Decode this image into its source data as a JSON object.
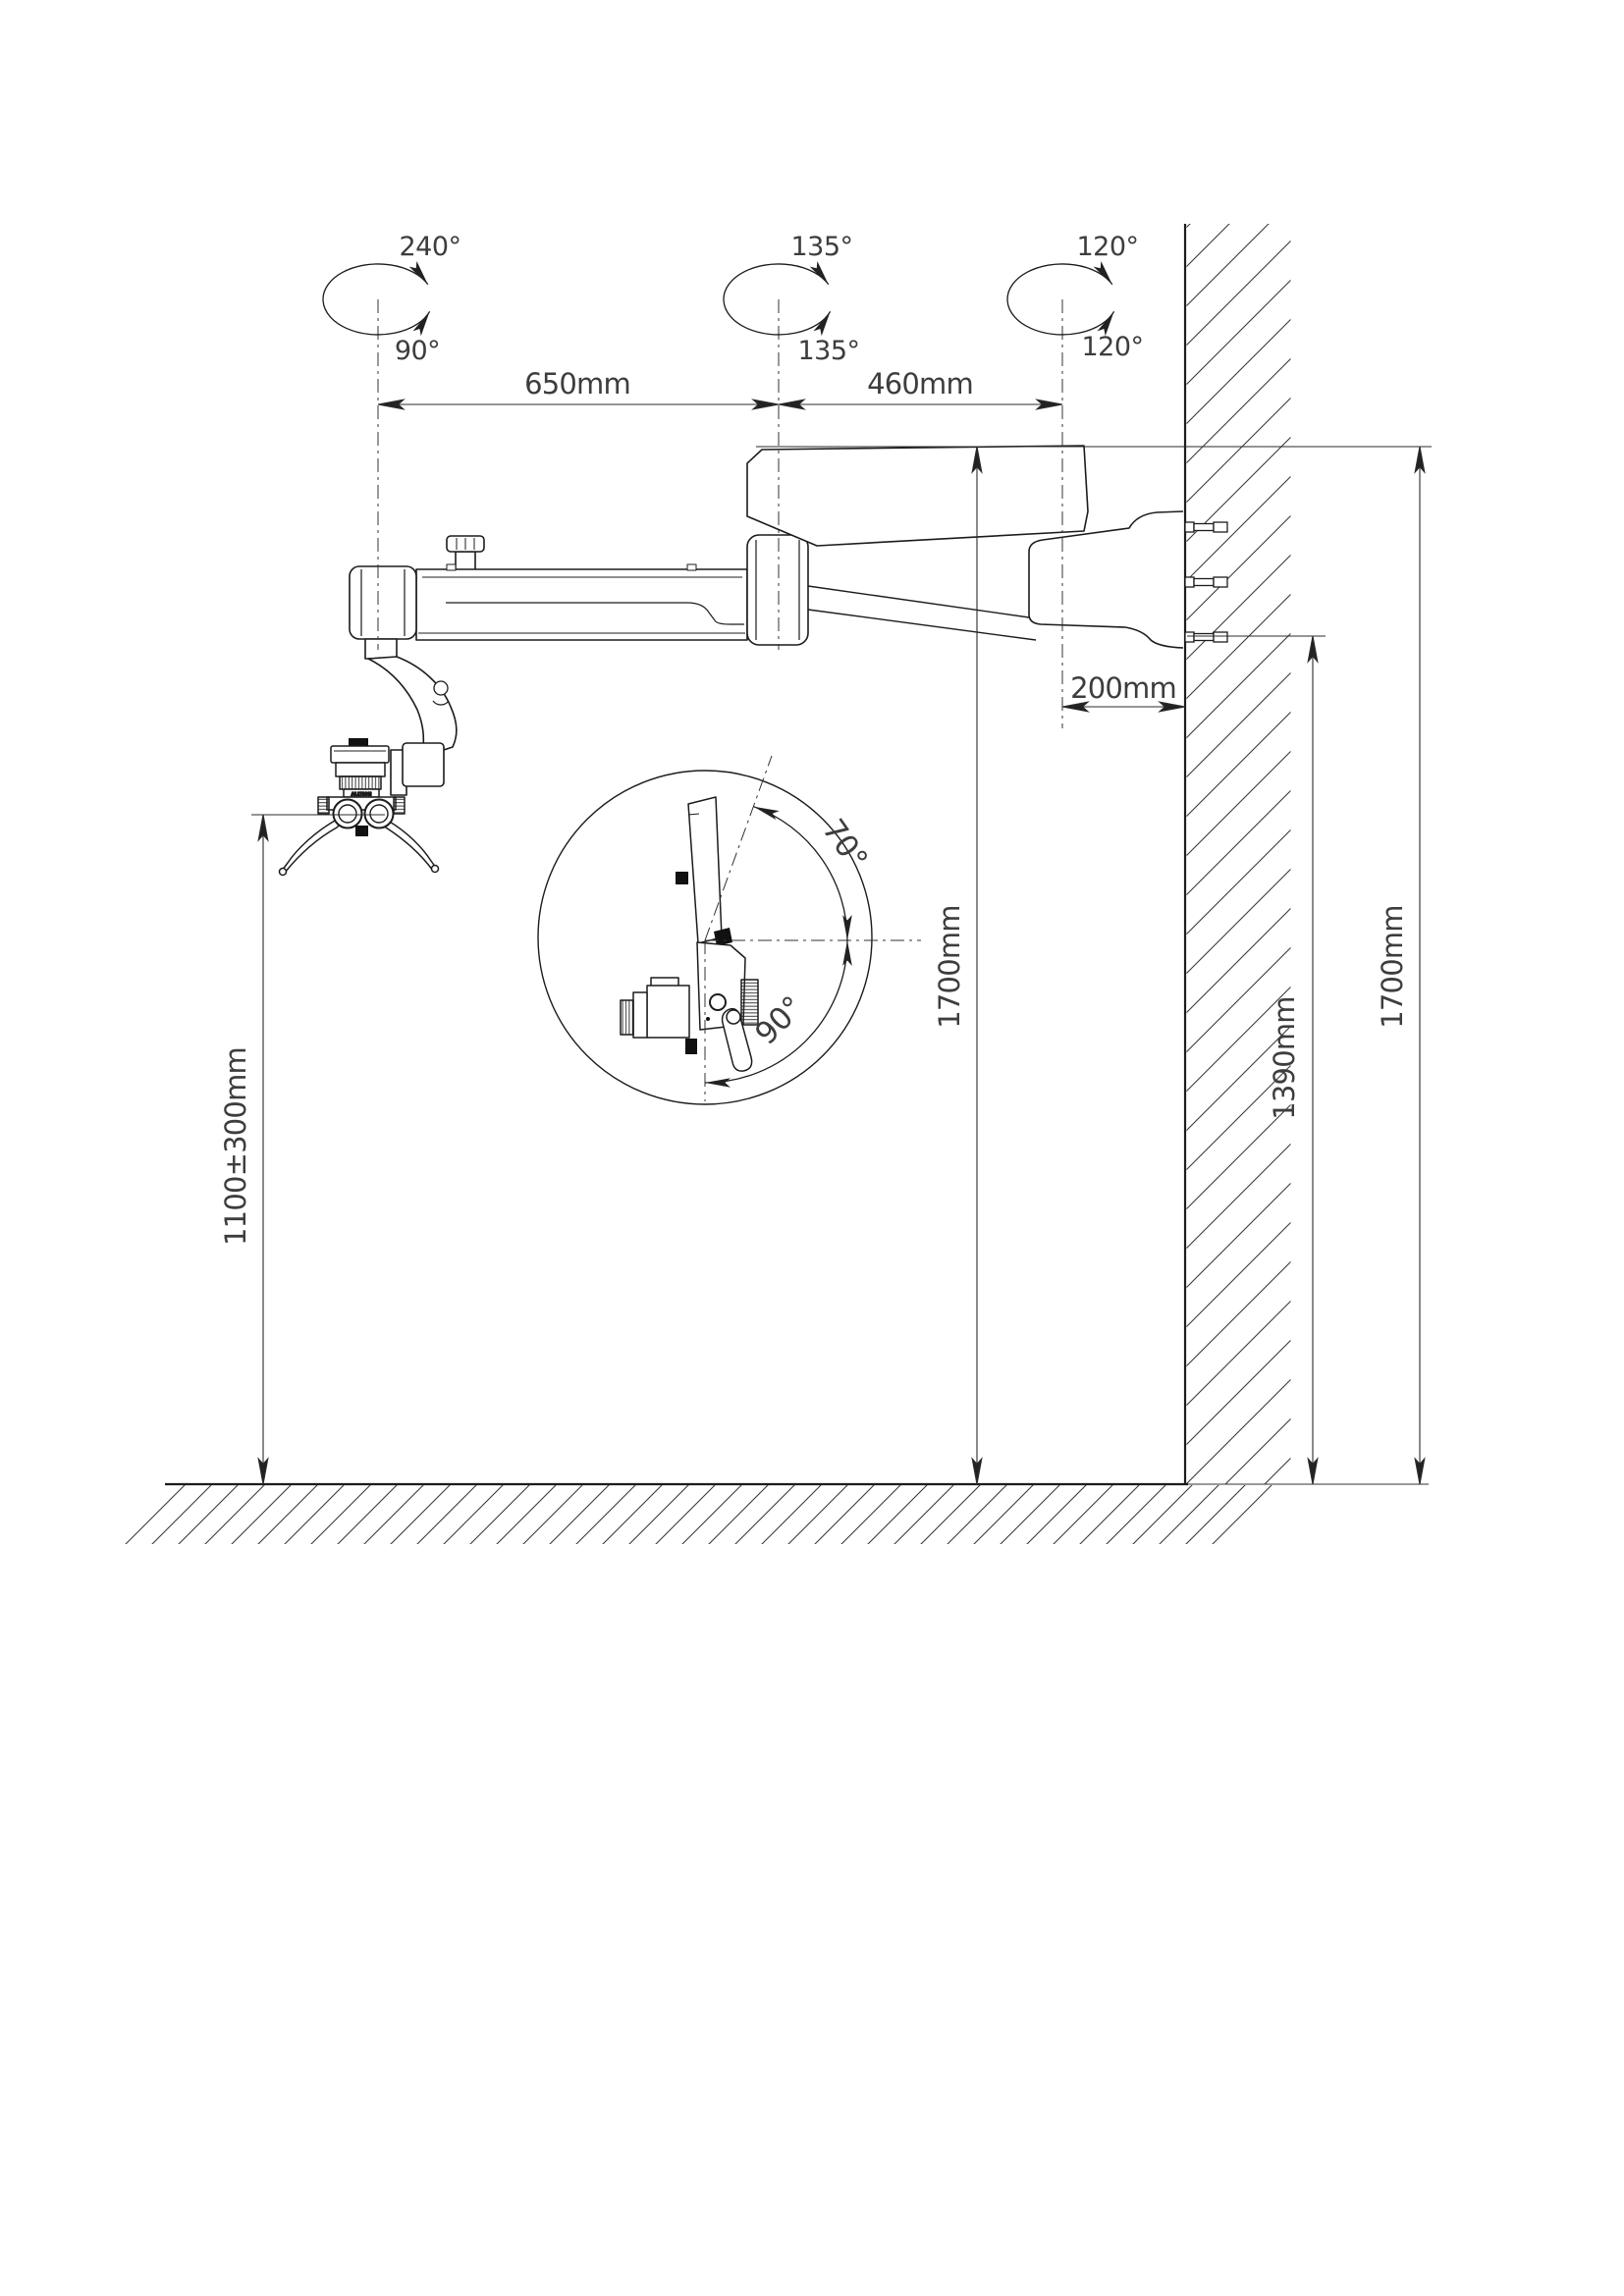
{
  "rotation_symbols": [
    {
      "top_label": "240°",
      "bottom_label": "90°"
    },
    {
      "top_label": "135°",
      "bottom_label": "135°"
    },
    {
      "top_label": "120°",
      "bottom_label": "120°"
    }
  ],
  "dimensions": {
    "arm1_span": "650mm",
    "arm2_span": "460mm",
    "wall_offset": "200mm",
    "working_height": "1100±300mm",
    "mount_height_inner": "1700mm",
    "bracket_bottom_height": "1390mm",
    "mount_height_outer": "1700mm"
  },
  "detail_view": {
    "tilt_up_angle": "70°",
    "tilt_down_angle": "90°"
  },
  "device": {
    "head_brand_text": "ALLTION"
  }
}
